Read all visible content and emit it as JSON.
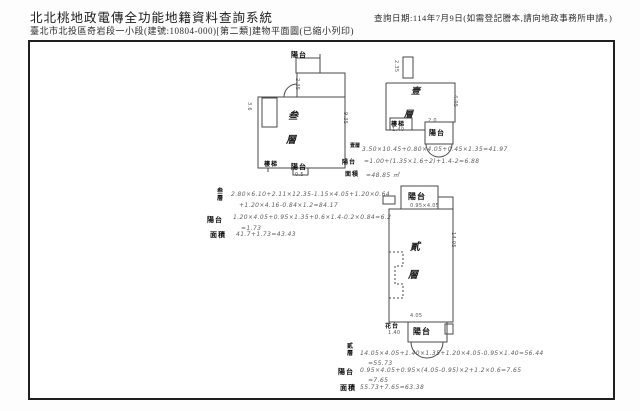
{
  "colors": {
    "paper": "#ffffff",
    "ink": "#1c1c1c",
    "pencil": "#3f3f3f"
  },
  "header": {
    "system_title": "北北桃地政電傳全功能地籍資料查詢系統",
    "query_date": "查詢日期:114年7月9日(如需登記謄本,請向地政事務所申請。)",
    "document_title": "臺北市北投區奇岩段一小段(建號:10804-000)[第二類]建物平面圖(已縮小列印)"
  },
  "plan_third": {
    "floor_char_top": "叁",
    "floor_char_bottom": "層",
    "balcony_top": "陽台",
    "balcony_bottom": "陽台",
    "stair": "樓梯",
    "dim_top": "2.35",
    "dim_right": "9.35",
    "dim_left": "3.6",
    "dim_bottom": "0.5"
  },
  "plan_first": {
    "floor_char_top": "壹",
    "floor_char_bottom": "層",
    "balcony": "陽台",
    "stair": "樓梯",
    "dim_top": "2.35",
    "dim_right": "4.05",
    "dim_stair": "1.40",
    "dim_balcony": "2.0"
  },
  "plan_second": {
    "floor_char_top": "貳",
    "floor_char_bottom": "層",
    "balcony_top": "陽台",
    "balcony_bottom": "陽台",
    "planter": "花台",
    "dim_balcony_top": "0.95×4.05",
    "dim_right": "14.05",
    "dim_bottom": "4.05",
    "dim_planter": "1.40"
  },
  "calc_first": {
    "row1_label": "壹層",
    "row1_formula": "3.50×10.45+0.80×4.05+0.45×1.35=41.97",
    "row2_label": "陽台",
    "row2_formula": "=1.00+(1.35×1.6÷2)+1.4-2=6.88",
    "row3_label": "面積",
    "row3_formula": "=48.85 ㎡"
  },
  "calc_third": {
    "row1_label_top": "叁",
    "row1_label_bottom": "層",
    "row1_formula_a": "2.80×6.10+2.11×12.35-1.15×4.05+1.20×0.64",
    "row1_formula_b": "+1.20×4.16-0.84×1.2=84.17",
    "row2_label": "陽台",
    "row2_formula_a": "1.20×4.05+0.95×1.35+0.6×1.4-0.2×0.84=6.2",
    "row2_formula_b": "=1.73",
    "row3_label": "面積",
    "row3_formula": "41.7+1.73=43.43"
  },
  "calc_second": {
    "row1_label_top": "貳",
    "row1_label_bottom": "層",
    "row1_formula_a": "14.05×4.05+1.40×1.35+1.20×4.05-0.95×1.40=56.44",
    "row1_formula_b": "=55.73",
    "row2_label": "陽台",
    "row2_formula_a": "0.95×4.05+0.95×(4.05-0.95)×2+1.2×0.6=7.65",
    "row2_formula_b": "=7.65",
    "row3_label": "面積",
    "row3_formula": "55.73+7.65=63.38"
  }
}
